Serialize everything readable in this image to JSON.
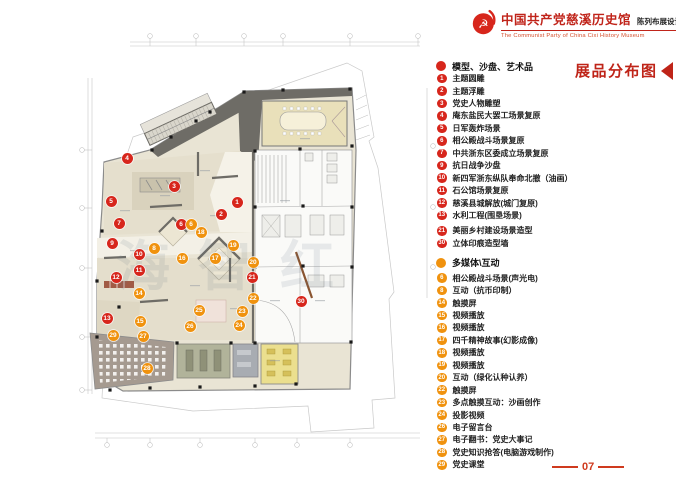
{
  "header": {
    "title_cn": "中国共产党慈溪历史馆",
    "subtitle_cn": "陈列布展设计施工方案",
    "subtitle_en": "The Communist Party of China Cixi History Museum"
  },
  "legend": {
    "title": "展品分布图",
    "sections": [
      {
        "header": "模型、沙盘、艺术品",
        "color": "#d7261c",
        "items": [
          {
            "n": "1",
            "label": "主题圆雕"
          },
          {
            "n": "2",
            "label": "主题浮雕"
          },
          {
            "n": "3",
            "label": "党史人物雕塑"
          },
          {
            "n": "4",
            "label": "庵东盐民大罢工场景复原"
          },
          {
            "n": "5",
            "label": "日军轰炸场景"
          },
          {
            "n": "6",
            "label": "相公殿战斗场景复原"
          },
          {
            "n": "7",
            "label": "中共浙东区委成立场景复原"
          },
          {
            "n": "9",
            "label": "抗日战争沙盘"
          },
          {
            "n": "10",
            "label": "新四军浙东纵队奉命北撤（油画）"
          },
          {
            "n": "11",
            "label": "石公馆场景复原"
          },
          {
            "n": "12",
            "label": "慈溪县城解放(城门复原)"
          },
          {
            "n": "13",
            "label": "水利工程(围垦场景)"
          },
          {
            "n": "21",
            "label": "美丽乡村建设场景造型",
            "gap": true
          },
          {
            "n": "30",
            "label": "立体印痕造型墙"
          }
        ]
      },
      {
        "header": "多媒体\\互动",
        "color": "#f0920e",
        "items": [
          {
            "n": "6",
            "label": "相公殿战斗场景(声光电)",
            "gap": true
          },
          {
            "n": "8",
            "label": "互动（抗币印制）"
          },
          {
            "n": "14",
            "label": "触摸屏"
          },
          {
            "n": "15",
            "label": "视频播放"
          },
          {
            "n": "16",
            "label": "视频播放"
          },
          {
            "n": "17",
            "label": "四千精神故事(幻影成像)"
          },
          {
            "n": "18",
            "label": "视频播放"
          },
          {
            "n": "19",
            "label": "视频播放"
          },
          {
            "n": "20",
            "label": "互动（绿化认种认养）"
          },
          {
            "n": "22",
            "label": "触摸屏"
          },
          {
            "n": "23",
            "label": "多点触摸互动：沙画创作"
          },
          {
            "n": "24",
            "label": "投影视频"
          },
          {
            "n": "26",
            "label": "电子留言台"
          },
          {
            "n": "27",
            "label": "电子翻书：党史大事记"
          },
          {
            "n": "28",
            "label": "党史知识抢答(电脑游戏制作)"
          },
          {
            "n": "29",
            "label": "党史课堂"
          }
        ]
      }
    ]
  },
  "plan": {
    "watermark": "海智红",
    "markers": [
      {
        "n": "1",
        "x": 237,
        "y": 202,
        "type": "red"
      },
      {
        "n": "2",
        "x": 221,
        "y": 214,
        "type": "red"
      },
      {
        "n": "3",
        "x": 174,
        "y": 186,
        "type": "red"
      },
      {
        "n": "4",
        "x": 127,
        "y": 158,
        "type": "red"
      },
      {
        "n": "5",
        "x": 111,
        "y": 201,
        "type": "red"
      },
      {
        "n": "6",
        "x": 181,
        "y": 224,
        "type": "red"
      },
      {
        "n": "7",
        "x": 119,
        "y": 223,
        "type": "red"
      },
      {
        "n": "9",
        "x": 112,
        "y": 243,
        "type": "red"
      },
      {
        "n": "10",
        "x": 139,
        "y": 254,
        "type": "red"
      },
      {
        "n": "11",
        "x": 139,
        "y": 270,
        "type": "red"
      },
      {
        "n": "12",
        "x": 116,
        "y": 277,
        "type": "red"
      },
      {
        "n": "13",
        "x": 107,
        "y": 318,
        "type": "red"
      },
      {
        "n": "21",
        "x": 252,
        "y": 277,
        "type": "red"
      },
      {
        "n": "30",
        "x": 301,
        "y": 301,
        "type": "red"
      },
      {
        "n": "6",
        "x": 191,
        "y": 224,
        "type": "orange"
      },
      {
        "n": "8",
        "x": 154,
        "y": 248,
        "type": "orange"
      },
      {
        "n": "14",
        "x": 139,
        "y": 293,
        "type": "orange"
      },
      {
        "n": "15",
        "x": 140,
        "y": 321,
        "type": "orange"
      },
      {
        "n": "16",
        "x": 182,
        "y": 258,
        "type": "orange"
      },
      {
        "n": "17",
        "x": 215,
        "y": 258,
        "type": "orange"
      },
      {
        "n": "18",
        "x": 201,
        "y": 232,
        "type": "orange"
      },
      {
        "n": "19",
        "x": 233,
        "y": 245,
        "type": "orange"
      },
      {
        "n": "20",
        "x": 253,
        "y": 262,
        "type": "orange"
      },
      {
        "n": "22",
        "x": 253,
        "y": 298,
        "type": "orange"
      },
      {
        "n": "23",
        "x": 242,
        "y": 311,
        "type": "orange"
      },
      {
        "n": "24",
        "x": 239,
        "y": 325,
        "type": "orange"
      },
      {
        "n": "25",
        "x": 199,
        "y": 310,
        "type": "orange"
      },
      {
        "n": "26",
        "x": 190,
        "y": 326,
        "type": "orange"
      },
      {
        "n": "27",
        "x": 143,
        "y": 336,
        "type": "orange"
      },
      {
        "n": "28",
        "x": 147,
        "y": 368,
        "type": "orange"
      },
      {
        "n": "29",
        "x": 113,
        "y": 335,
        "type": "orange"
      }
    ]
  },
  "colors": {
    "red": "#d7261c",
    "orange": "#f0920e",
    "accent": "#bf2418"
  },
  "footer": {
    "page_number": "07"
  }
}
